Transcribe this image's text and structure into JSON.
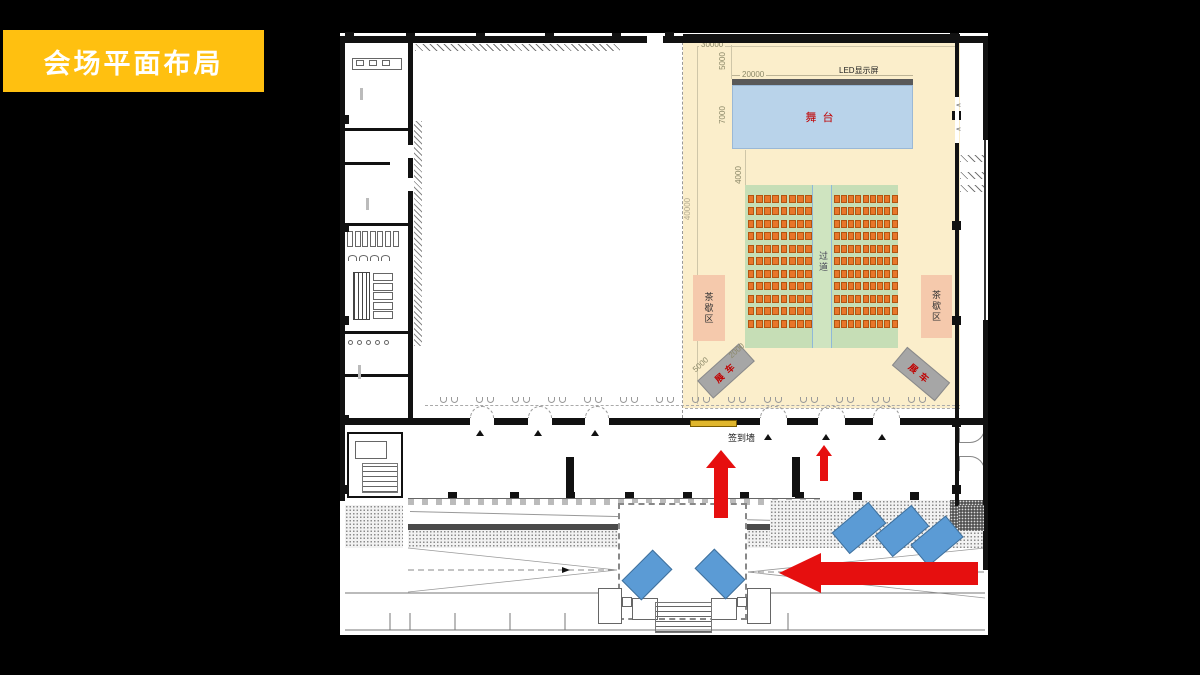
{
  "banner": {
    "title": "会场平面布局",
    "color": "#ffc010"
  },
  "plan": {
    "stage": {
      "label": "舞台",
      "fill": "#b9d3ea",
      "text_color": "#c00000"
    },
    "led": {
      "label": "LED显示屏",
      "bar_color": "#595959"
    },
    "aisle": {
      "label": "过道"
    },
    "tea_area": {
      "label": "茶歇区",
      "fill": "#f5c9ac"
    },
    "display_car": {
      "label": "展车",
      "fill": "#a6a6a6",
      "text_color": "#c00000"
    },
    "signin_wall": {
      "label": "签到墙",
      "bar_color": "#e0b62c"
    },
    "dimensions": {
      "top_width": "30000",
      "stage_width": "20000",
      "stage_gap": "5000",
      "stage_depth": "7000",
      "front_gap": "4000",
      "hall_depth": "40000",
      "car_dim_a": "5000",
      "car_dim_b": "2000"
    },
    "seating": {
      "rows": 11,
      "left_cols": 8,
      "right_cols": 9,
      "seat_color": "#e8762a",
      "block_color": "#c6deb6"
    },
    "colors": {
      "hall_highlight": "#fbeecb",
      "arrow_red": "#e60f0f",
      "desk_blue": "#5b9bd5",
      "background": "#000000"
    }
  }
}
